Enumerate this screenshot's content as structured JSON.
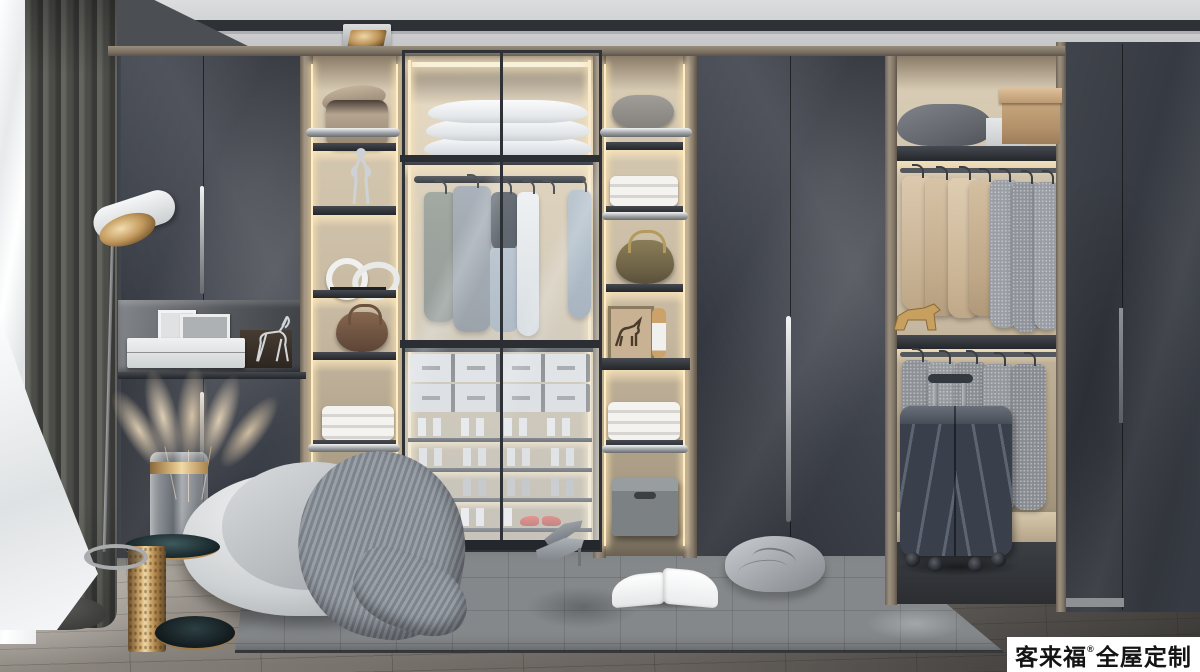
{
  "meta": {
    "type": "interior-render",
    "room": "walk-in-closet-showroom"
  },
  "watermark": {
    "brand": "客来福",
    "registered": "®",
    "suffix": "全屋定制"
  },
  "palette": {
    "ceiling": "#d5d6d8",
    "panel_dark": "#3b3f48",
    "wood_trim": "#8b7f6f",
    "interior_wood": "#c8baa2",
    "warm_led": "#ffedc8",
    "gold": "#c39e66",
    "floor": "#8f8880",
    "rug": "#85888b",
    "suitcase": "#3e4450",
    "red_shoes": "#cf3a2e",
    "blanket": "#8d939b",
    "curtain": "#47484c"
  },
  "objects": [
    "window-sheer-curtain",
    "dark-curtain",
    "floor-lamp",
    "left-wardrobe",
    "display-niche",
    "open-shelf-column-left",
    "glass-door-wardrobe",
    "hanging-clothes",
    "pillow-stack",
    "drawer-boxes",
    "shoe-shelves",
    "open-shelf-column-right",
    "double-doors",
    "right-open-wardrobe",
    "suitcase",
    "far-right-wardrobe",
    "area-rug",
    "pouf-with-blanket",
    "side-table",
    "pampas-grass-vase",
    "open-book",
    "floor-pillow",
    "storage-stool",
    "high-heels"
  ]
}
